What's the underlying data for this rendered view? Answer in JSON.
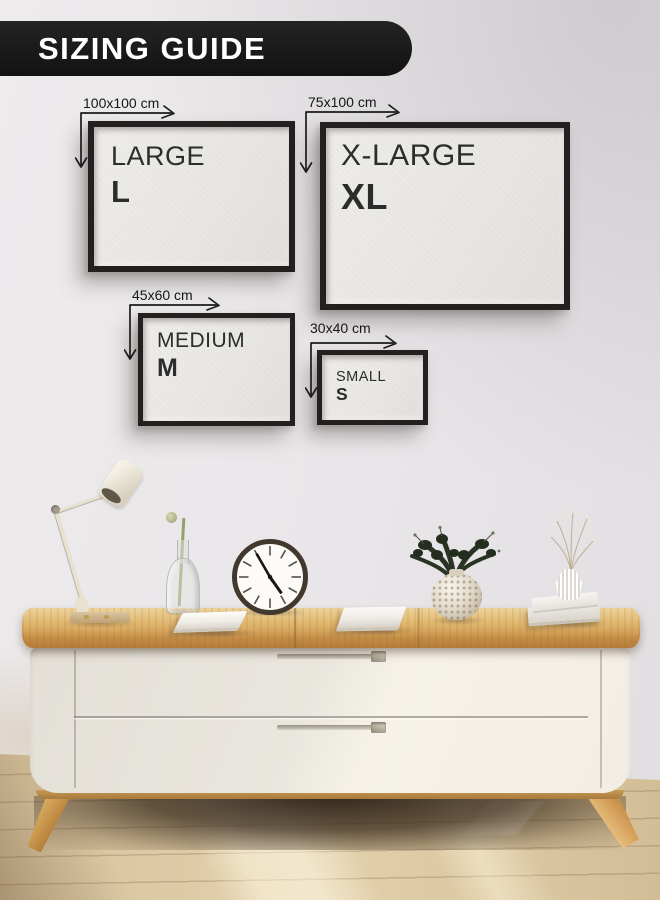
{
  "banner": {
    "label": "SIZING GUIDE"
  },
  "frames": [
    {
      "size_name": "LARGE",
      "size_abbr": "L",
      "dimensions": "100x100 cm"
    },
    {
      "size_name": "X-LARGE",
      "size_abbr": "XL",
      "dimensions": "75x100 cm"
    },
    {
      "size_name": "MEDIUM",
      "size_abbr": "M",
      "dimensions": "45x60 cm"
    },
    {
      "size_name": "SMALL",
      "size_abbr": "S",
      "dimensions": "30x40 cm"
    }
  ],
  "scene": {
    "clock": {
      "approx_time": "4:55"
    },
    "decor_items": [
      "desk-lamp",
      "bud-vase-with-stem",
      "wall-clock",
      "notebook",
      "notebook",
      "hobnail-vase-with-foliage",
      "fluted-vase-with-dried-flowers",
      "book-stack"
    ],
    "colors": {
      "banner_bg": "#191919",
      "banner_text": "#ffffff",
      "wall": "#e9e6e9",
      "frame": "#222120",
      "canvas": "#eae8e5",
      "label_text": "#161616",
      "wood_top": "#d8a85f",
      "cabinet": "#efece5",
      "floor": "#dcc8a2"
    }
  }
}
